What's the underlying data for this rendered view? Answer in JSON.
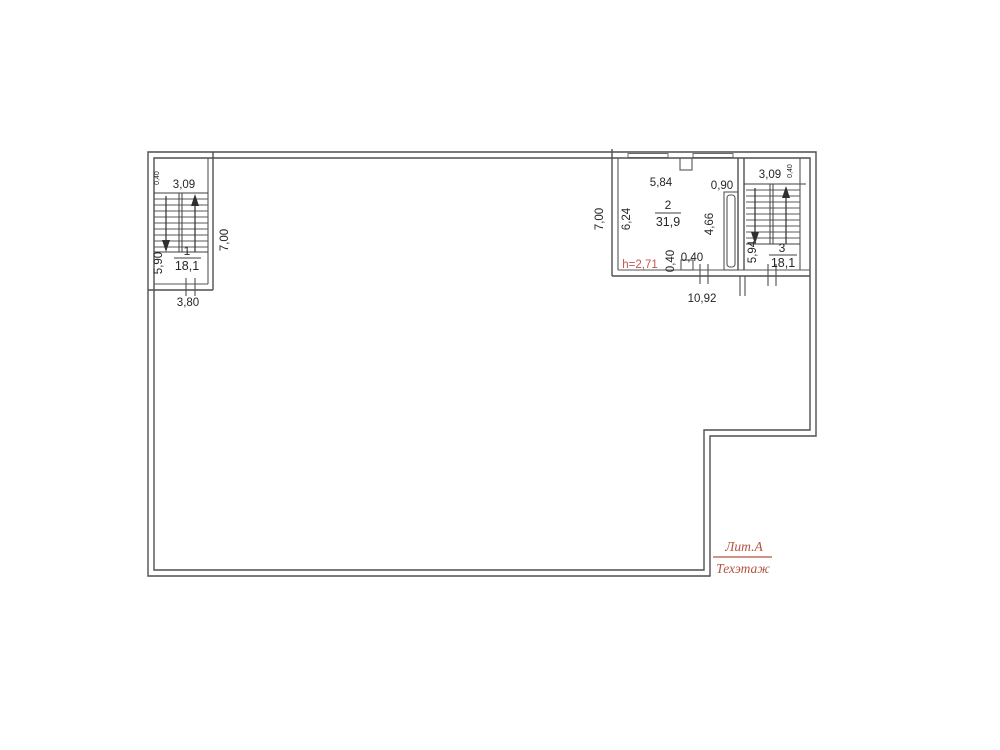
{
  "annotation": {
    "liter": "Лит.А",
    "floor": "Техэтаж"
  },
  "colors": {
    "line": "#4f4f4f",
    "text": "#262626",
    "height_note_red": "#c2584c",
    "annotation_red": "#b35340"
  },
  "rooms": {
    "stair1": {
      "number": "1",
      "area": "18,1"
    },
    "room2": {
      "number": "2",
      "area": "31,9",
      "height_note": "h=2,71"
    },
    "stair3": {
      "number": "3",
      "area": "18,1"
    }
  },
  "dimensions": {
    "stair1": {
      "wall_top": "0,40",
      "width_top": "3,09",
      "length_left": "5,90",
      "width_bottom": "3,80",
      "depth_right": "7,00"
    },
    "room2": {
      "depth_left": "7,00",
      "width_top": "5,84",
      "gap_top_right": "0,90",
      "length_left": "6,24",
      "length_right": "4,66",
      "niche_depth": "0,40",
      "niche_width": "0,40",
      "width_bottom": "10,92"
    },
    "stair3": {
      "width_top": "3,09",
      "wall_top": "0,40",
      "length_left": "5,94"
    }
  }
}
